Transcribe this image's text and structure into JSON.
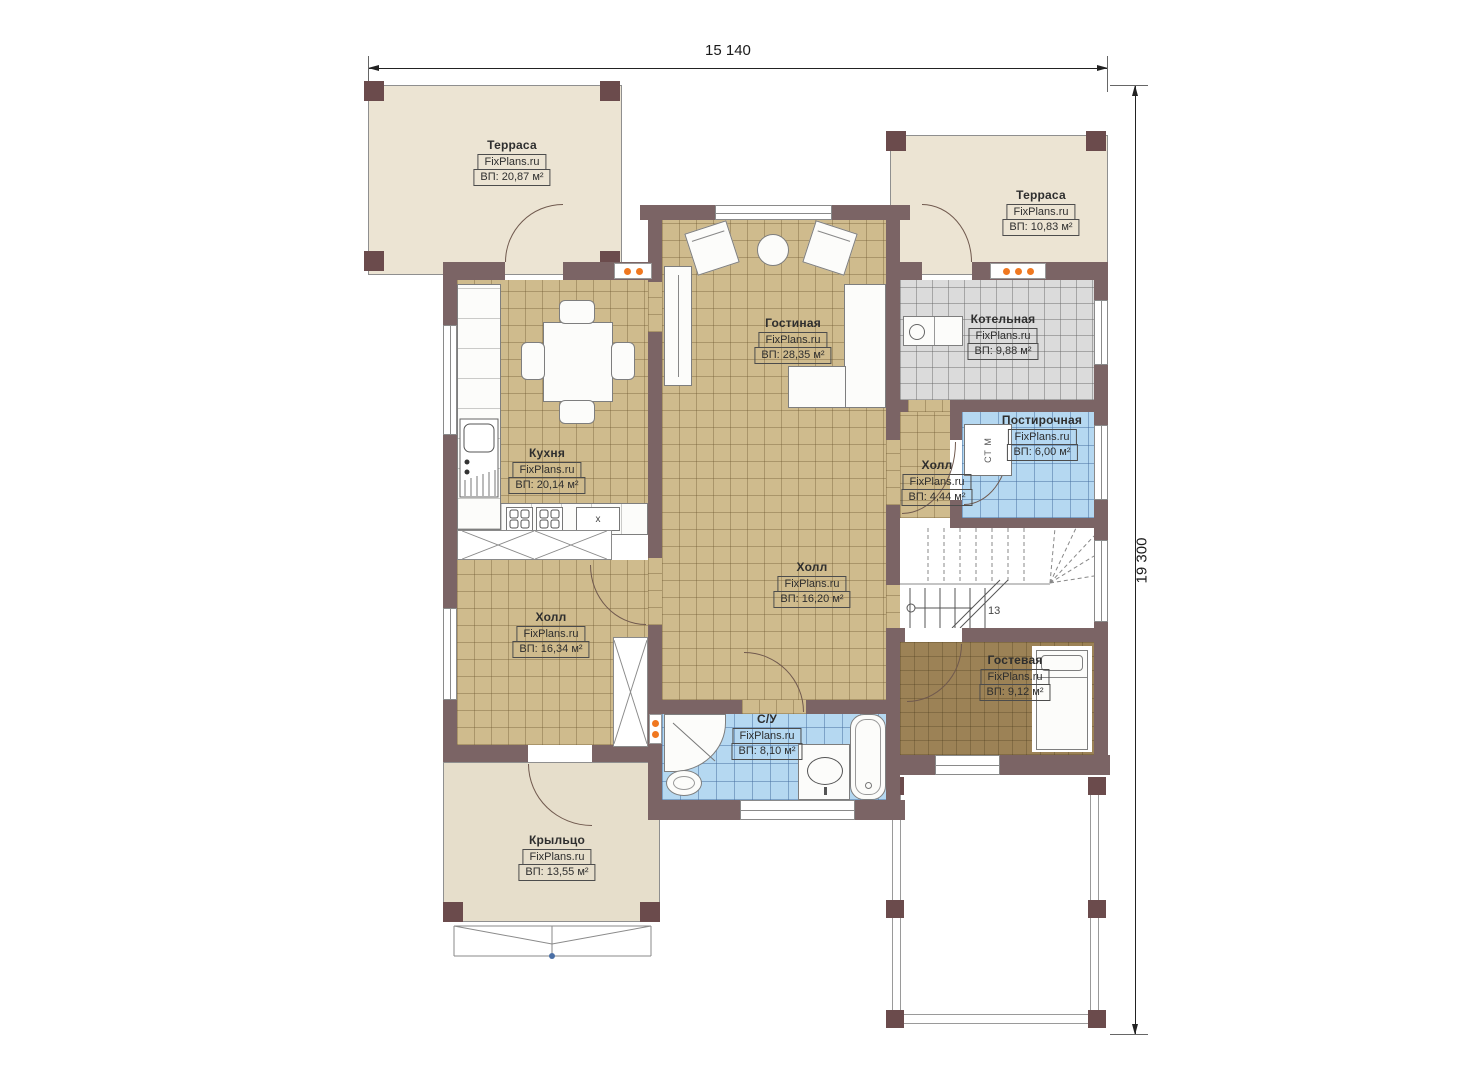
{
  "dimensions": {
    "width": "15 140",
    "height": "19 300"
  },
  "rooms": {
    "terrace_tl": {
      "name": "Терраса",
      "watermark": "FixPlans.ru",
      "area": "ВП: 20,87 м²"
    },
    "terrace_tr": {
      "name": "Терраса",
      "watermark": "FixPlans.ru",
      "area": "ВП: 10,83 м²"
    },
    "living": {
      "name": "Гостиная",
      "watermark": "FixPlans.ru",
      "area": "ВП: 28,35 м²"
    },
    "boiler": {
      "name": "Котельная",
      "watermark": "FixPlans.ru",
      "area": "ВП: 9,88 м²"
    },
    "kitchen": {
      "name": "Кухня",
      "watermark": "FixPlans.ru",
      "area": "ВП: 20,14 м²"
    },
    "laundry": {
      "name": "Постирочная",
      "watermark": "FixPlans.ru",
      "area": "ВП: 6,00 м²"
    },
    "hall_small": {
      "name": "Холл",
      "watermark": "FixPlans.ru",
      "area": "ВП: 4,44 м²"
    },
    "hall_center": {
      "name": "Холл",
      "watermark": "FixPlans.ru",
      "area": "ВП: 16,20 м²"
    },
    "hall_left": {
      "name": "Холл",
      "watermark": "FixPlans.ru",
      "area": "ВП: 16,34 м²"
    },
    "guest": {
      "name": "Гостевая",
      "watermark": "FixPlans.ru",
      "area": "ВП: 9,12 м²"
    },
    "bathroom": {
      "name": "С/У",
      "watermark": "FixPlans.ru",
      "area": "ВП: 8,10 м²"
    },
    "porch": {
      "name": "Крыльцо",
      "watermark": "FixPlans.ru",
      "area": "ВП: 13,55 м²"
    }
  },
  "annotations": {
    "stairs_count": "13",
    "washer": "СТ М",
    "stove": "x"
  },
  "colors": {
    "wall": "#7b6465",
    "wall_post": "#6b4b4c",
    "floor_tan": "#cfbb8d",
    "floor_gray": "#dbdbdb",
    "floor_blue": "#b5d8f1",
    "floor_guest": "#9c8256",
    "terrace": "#ece4d3",
    "porch": "#e6decb",
    "radiator": "#f07820"
  }
}
